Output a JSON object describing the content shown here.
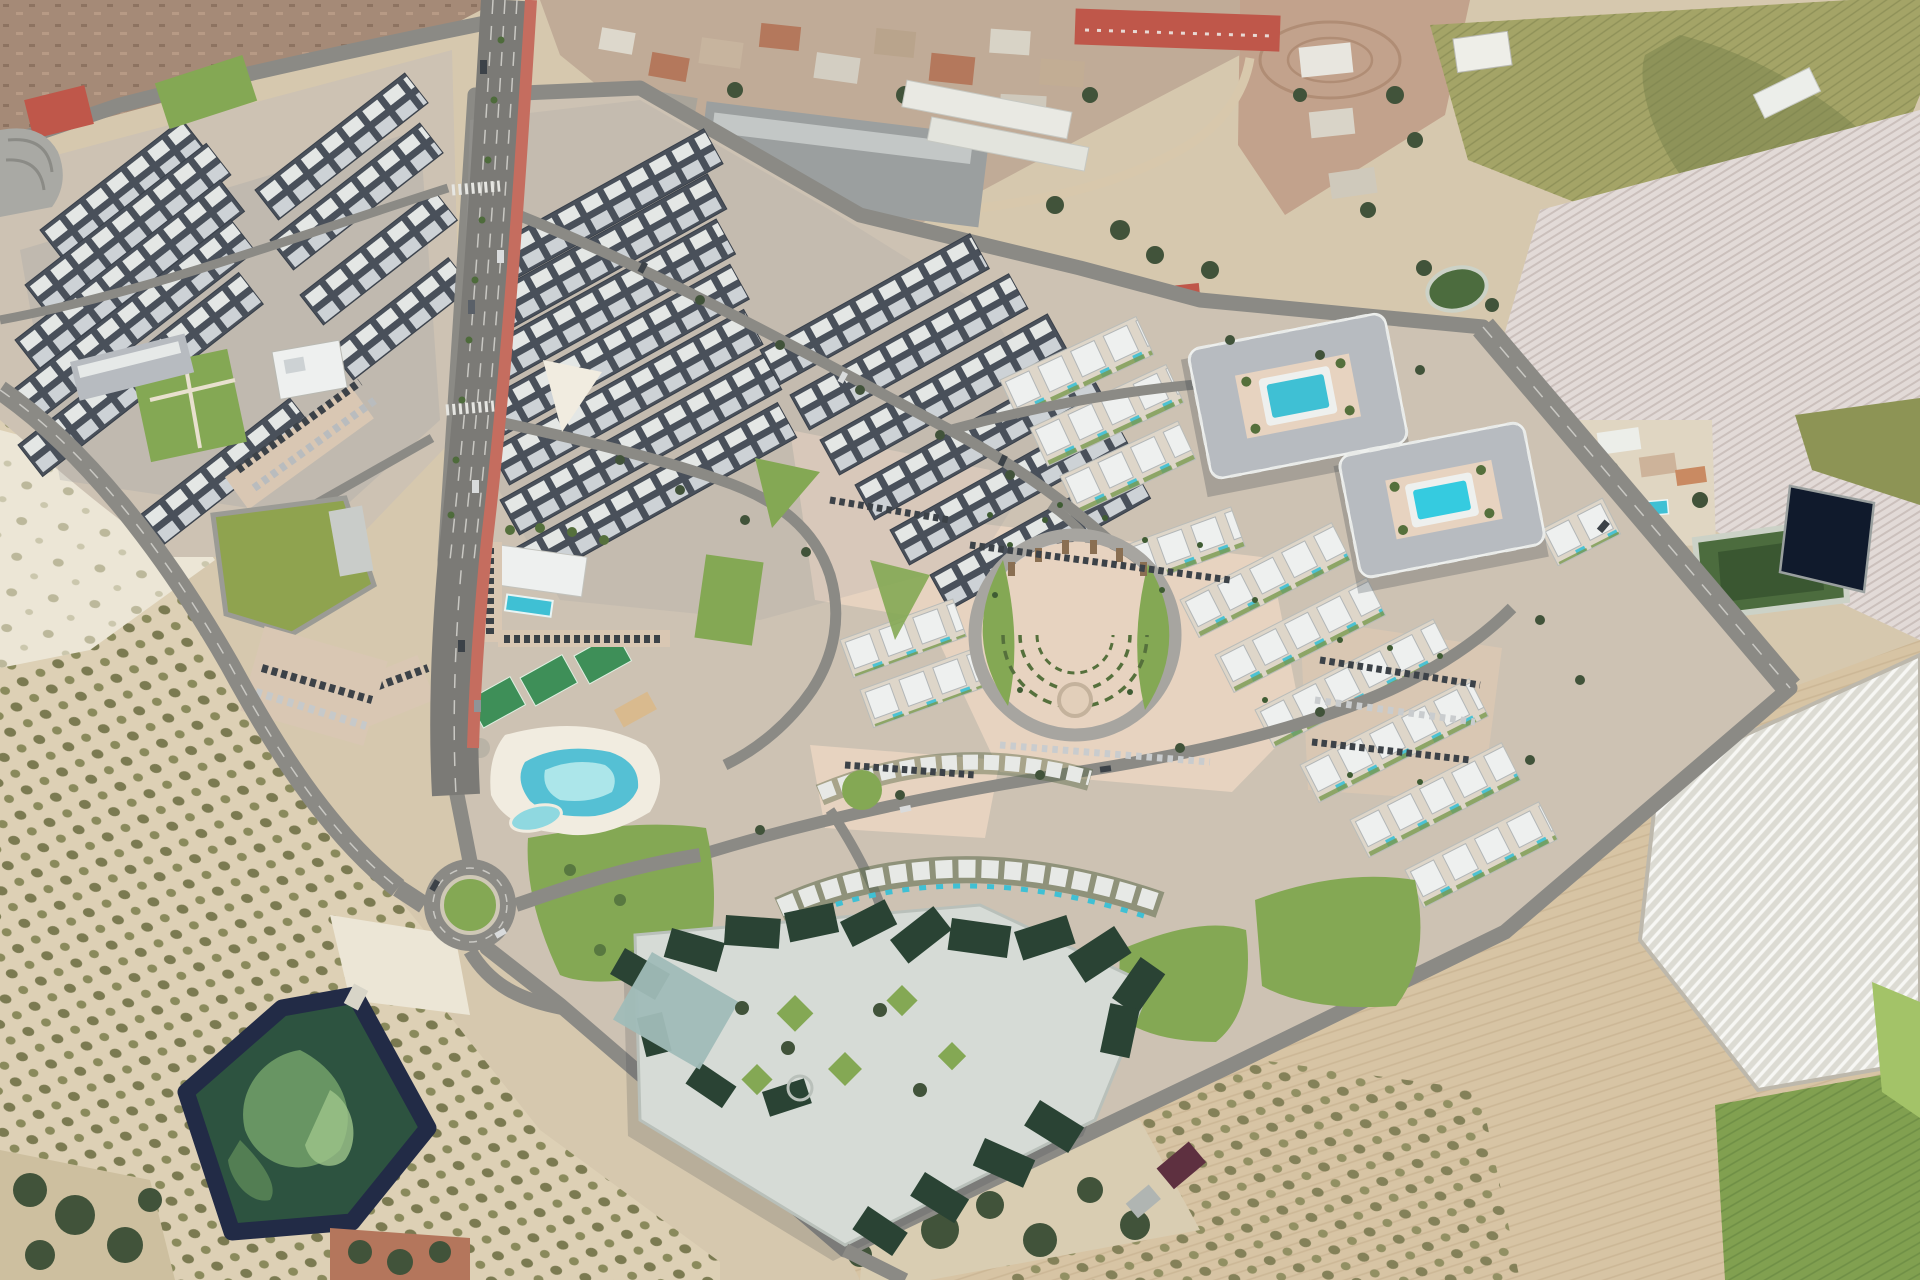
{
  "meta": {
    "scene": "aerial-3d-render-master-plan-community",
    "visible_text": "none"
  },
  "features": {
    "roundabout_count": 1,
    "ring_pool_blocks": 2,
    "tennis_courts": 3,
    "lagoon_pools": 2,
    "reservoirs": 1,
    "farm_ponds": 3,
    "names": [
      "desert-terrain",
      "olive-groves",
      "irrigation-reservoir",
      "highway-red-cycle-lane",
      "roundabout",
      "townhouse-rows",
      "villa-rows",
      "apartment-ring-pools",
      "lagoon-pool",
      "tennis-courts",
      "central-plaza",
      "lawns",
      "dark-green-roof-complex",
      "old-village",
      "farm-fields",
      "greenhouse-field",
      "farm-ponds",
      "green-roof-commercial"
    ]
  },
  "palette": {
    "sand_base": "#d6c8ae",
    "sand_light": "#e6dcc6",
    "dirt_pale": "#ece6d6",
    "olive_soil": "#ddd0b5",
    "farm_pink": "#c2a28c",
    "hill_rock": "#a58a77",
    "crop_olive": "#a4a467",
    "crop_olive_dark": "#77814b",
    "field_pale": "#e2dad7",
    "field_tan": "#d7c4a4",
    "field_green": "#81a050",
    "field_green_bright": "#a3c368",
    "reeds": "#8d9455",
    "road": "#8b8a85",
    "road_light": "#a7a5a0",
    "highway": "#7b7a76",
    "lane_mark": "#c9c8c3",
    "red_lane": "#c56d5f",
    "dev_paving": "#cdc2b3",
    "plaza_sand": "#e7d3c0",
    "parking_sand": "#d9c7b3",
    "lawn": "#84a854",
    "lawn_dark": "#6b9246",
    "hedge": "#55703c",
    "tree_dark": "#41533a",
    "roof_slate": "#49505a",
    "roof_white": "#e9ebe8",
    "roof_gray": "#b7bbc0",
    "villa_white": "#eef0ef",
    "shadow": "#333a44",
    "pool_teal": "#3fc0d4",
    "pool_bright": "#35cbe0",
    "pool_light": "#ace6ea",
    "beach": "#f1ece0",
    "reservoir_rim": "#222b46",
    "reservoir_water": "#2d5340",
    "reservoir_algae": "#6f9c67",
    "pond_navy": "#101a2c",
    "pond_green": "#4c6c3e",
    "pond_rim": "#ccd2c7",
    "complex_roof": "#2a4334",
    "complex_plaza": "#d6dbd6",
    "canopy_teal": "#a0bcb8",
    "village_base": "#c0ab97",
    "village_roof": "#b4785c",
    "village_gray": "#9b9f9f",
    "red_roof": "#bf574a",
    "court_green": "#3e8f58",
    "greenhouse": "#dcdbd3",
    "greenhouse_stripe": "#f7f7f4",
    "car_dark": "#3c4248",
    "car_light": "#d9dbdc",
    "maroon_roof": "#5e3040",
    "green_roof_bldg": "#8fa34f"
  }
}
